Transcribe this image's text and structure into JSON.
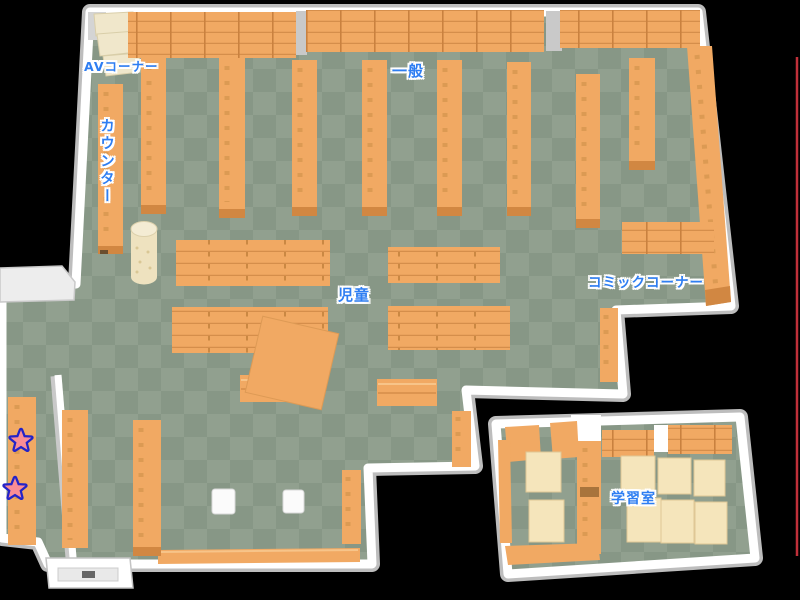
{
  "labels": {
    "av_corner": "AVコーナー",
    "counter": "カウンター",
    "general": "一般",
    "children": "児童",
    "comic_corner": "コミックコーナー",
    "study_room": "学習室"
  },
  "markers": {
    "star_count": 2
  },
  "colors": {
    "background": "#000000",
    "floor_light": "#91a08f",
    "floor_dark": "#879786",
    "shelf": "#f1a963",
    "shelf_dark": "#d18742",
    "table": "#f5e5bb",
    "wall": "#ffffff",
    "label_text": "#2e7ef2",
    "star_fill": "#f98d95",
    "star_outline": "#2323c8",
    "edge_line": "#c0303a"
  }
}
